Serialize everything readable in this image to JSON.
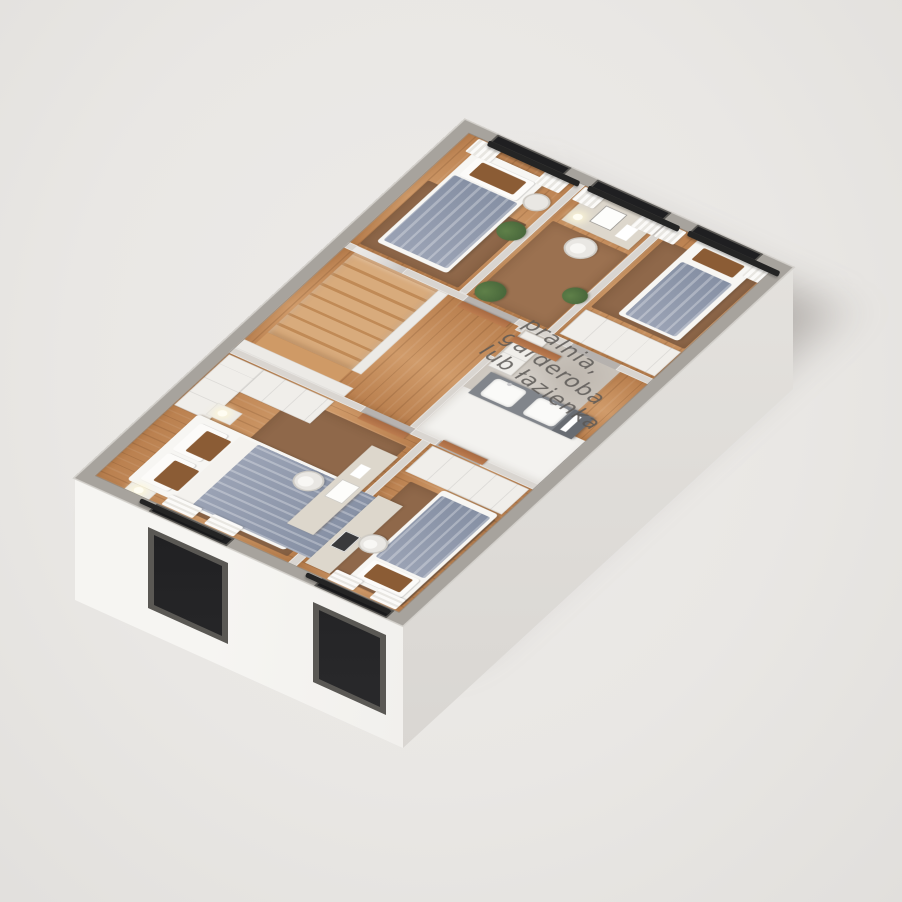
{
  "scene": {
    "type": "3d-floorplan-axonometric-render",
    "floor_label": {
      "line1": "pralnia,",
      "line2": "garderoba",
      "line3": "lub łazienka"
    },
    "rooms": [
      "master-bedroom",
      "bottom-bedroom",
      "top-bedroom",
      "desk-room",
      "right-bedroom",
      "utility-room",
      "bathroom-zone",
      "stair-hall",
      "hallway"
    ],
    "window_count": 5,
    "bed_count": 4
  },
  "palette": {
    "bg": "#e9e7e4",
    "bg2": "#edebe9",
    "bg3": "#e1dfdc",
    "face_light": "#f6f5f2",
    "face_mid": "#e9e7e3",
    "face_shade": "#d6d3cf",
    "wall_ext": "#a7a39d",
    "wall_int": "#d9d5d0",
    "wood": "#c48c5c",
    "wood_dark": "#b97f4e",
    "wood_light": "#d09b6a",
    "stair": "#d8ab7c",
    "concrete": "#cdc7bf",
    "floor_white": "#f3f2ef",
    "rug": "#8f684a",
    "blanket": "#9aa2b4",
    "blanket_dark": "#8690a4",
    "bed_white": "#f7f6f3",
    "cushion": "#8b5c35",
    "wardrobe": "#f0eeea",
    "door": "#bc7c4f",
    "desk": "#ddd7cc",
    "vanity": "#81858b",
    "vanity_dark": "#686c72",
    "sink": "#fafaf8",
    "glass": "#1f1f21",
    "frame": "#5a5854",
    "curtain": "#f8f7f4",
    "plant": "#5f8049",
    "plant_dark": "#47663a",
    "label": "#5b5855",
    "shadow": "rgba(109,103,97,0.42)"
  }
}
